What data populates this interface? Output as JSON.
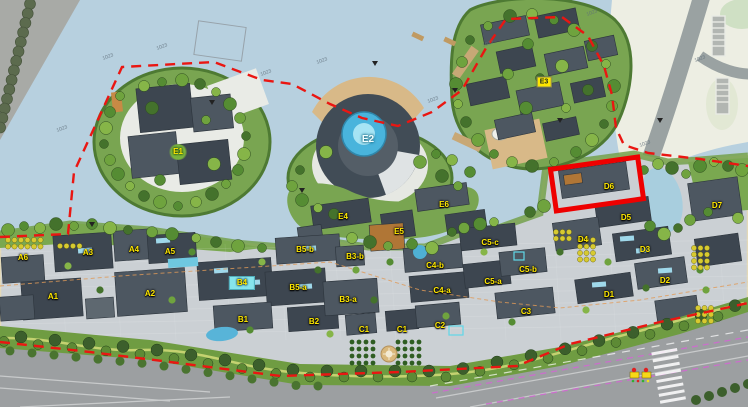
{
  "map": {
    "type": "architectural-master-plan-rendering",
    "highlighted_building": "D6",
    "colors": {
      "water": "#b7d0df",
      "paving": "#cbd0d4",
      "green": "#79a551",
      "green_dark": "#3c5f2c",
      "roof_dark": "#3d4650",
      "boundary_red": "#ea1612",
      "highlight_red": "#ee0000",
      "label_yellow": "#ffe800",
      "label_cyan_bg": "#86e4ec",
      "road_gray": "#9c9fa1",
      "cream_land": "#edeee3",
      "tan_beach": "#d8b988",
      "lane_magenta": "#cf6ad0"
    }
  },
  "building_labels": [
    {
      "text": "E1",
      "x": 178,
      "y": 152,
      "variant": "green-dot"
    },
    {
      "text": "E2",
      "x": 368,
      "y": 140,
      "variant": "white"
    },
    {
      "text": "E3",
      "x": 544,
      "y": 82,
      "variant": "yellow-chip"
    },
    {
      "text": "E4",
      "x": 343,
      "y": 217,
      "variant": "yellow"
    },
    {
      "text": "E5",
      "x": 399,
      "y": 232,
      "variant": "yellow"
    },
    {
      "text": "E6",
      "x": 444,
      "y": 205,
      "variant": "yellow"
    },
    {
      "text": "A6",
      "x": 23,
      "y": 258,
      "variant": "yellow"
    },
    {
      "text": "A3",
      "x": 88,
      "y": 253,
      "variant": "yellow"
    },
    {
      "text": "A4",
      "x": 134,
      "y": 250,
      "variant": "yellow"
    },
    {
      "text": "A5",
      "x": 170,
      "y": 252,
      "variant": "yellow"
    },
    {
      "text": "A1",
      "x": 53,
      "y": 297,
      "variant": "yellow"
    },
    {
      "text": "A2",
      "x": 150,
      "y": 294,
      "variant": "yellow"
    },
    {
      "text": "B4",
      "x": 242,
      "y": 283,
      "variant": "cyan-chip"
    },
    {
      "text": "B5-b",
      "x": 305,
      "y": 250,
      "variant": "yellow"
    },
    {
      "text": "B5-a",
      "x": 298,
      "y": 288,
      "variant": "yellow"
    },
    {
      "text": "B3-b",
      "x": 355,
      "y": 257,
      "variant": "yellow"
    },
    {
      "text": "B3-a",
      "x": 348,
      "y": 300,
      "variant": "yellow"
    },
    {
      "text": "B1",
      "x": 243,
      "y": 320,
      "variant": "yellow"
    },
    {
      "text": "B2",
      "x": 314,
      "y": 322,
      "variant": "yellow"
    },
    {
      "text": "C1",
      "x": 364,
      "y": 330,
      "variant": "yellow"
    },
    {
      "text": "C1",
      "x": 402,
      "y": 330,
      "variant": "yellow"
    },
    {
      "text": "C2",
      "x": 440,
      "y": 326,
      "variant": "yellow"
    },
    {
      "text": "C3",
      "x": 526,
      "y": 312,
      "variant": "yellow"
    },
    {
      "text": "C4-a",
      "x": 442,
      "y": 291,
      "variant": "yellow"
    },
    {
      "text": "C4-b",
      "x": 435,
      "y": 266,
      "variant": "yellow"
    },
    {
      "text": "C5-a",
      "x": 493,
      "y": 282,
      "variant": "yellow"
    },
    {
      "text": "C5-b",
      "x": 528,
      "y": 270,
      "variant": "yellow"
    },
    {
      "text": "C5-c",
      "x": 490,
      "y": 243,
      "variant": "yellow"
    },
    {
      "text": "D1",
      "x": 609,
      "y": 295,
      "variant": "yellow"
    },
    {
      "text": "D2",
      "x": 665,
      "y": 281,
      "variant": "yellow"
    },
    {
      "text": "D3",
      "x": 645,
      "y": 250,
      "variant": "yellow"
    },
    {
      "text": "D4",
      "x": 583,
      "y": 240,
      "variant": "yellow"
    },
    {
      "text": "D5",
      "x": 626,
      "y": 218,
      "variant": "yellow"
    },
    {
      "text": "D6",
      "x": 609,
      "y": 187,
      "variant": "yellow"
    },
    {
      "text": "D7",
      "x": 717,
      "y": 206,
      "variant": "yellow"
    }
  ],
  "annotations": [
    {
      "text": "1023",
      "x": 108,
      "y": 57
    },
    {
      "text": "1023",
      "x": 162,
      "y": 47
    },
    {
      "text": "1023",
      "x": 266,
      "y": 73
    },
    {
      "text": "1023",
      "x": 322,
      "y": 61
    },
    {
      "text": "1023",
      "x": 433,
      "y": 100
    },
    {
      "text": "1023",
      "x": 488,
      "y": 44
    },
    {
      "text": "1023",
      "x": 592,
      "y": 13
    },
    {
      "text": "1023",
      "x": 645,
      "y": 144
    },
    {
      "text": "1023",
      "x": 700,
      "y": 59
    },
    {
      "text": "1023",
      "x": 62,
      "y": 129
    }
  ],
  "icons": [
    {
      "name": "traffic-signal-icon"
    },
    {
      "name": "fountain-icon"
    }
  ]
}
